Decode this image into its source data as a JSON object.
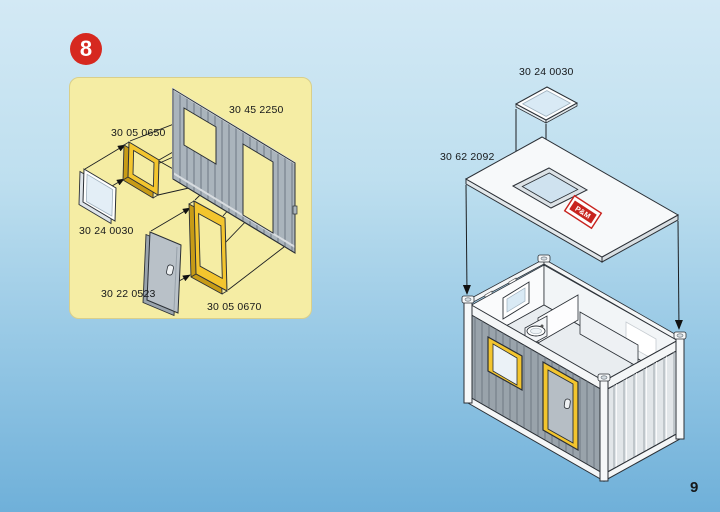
{
  "page": {
    "step_badge": "8",
    "page_number": "9"
  },
  "colors": {
    "background_top": "#d3e9f5",
    "background_bottom": "#6fb0d9",
    "panel_yellow": "#f5eda4",
    "badge_red": "#d6281f",
    "frame_yellow": "#f3c52e",
    "logo_red": "#c8241f"
  },
  "exploded_view": {
    "labels": {
      "wall_panel": "30 45 2250",
      "window_frame": "30 05 0650",
      "window_pane": "30 24 0030",
      "door": "30 22 0523",
      "door_frame": "30 05 0670"
    }
  },
  "assembly_view": {
    "labels": {
      "skylight_pane": "30 24 0030",
      "roof_panel": "30 62 2092"
    },
    "roof_logo": "P&M"
  }
}
